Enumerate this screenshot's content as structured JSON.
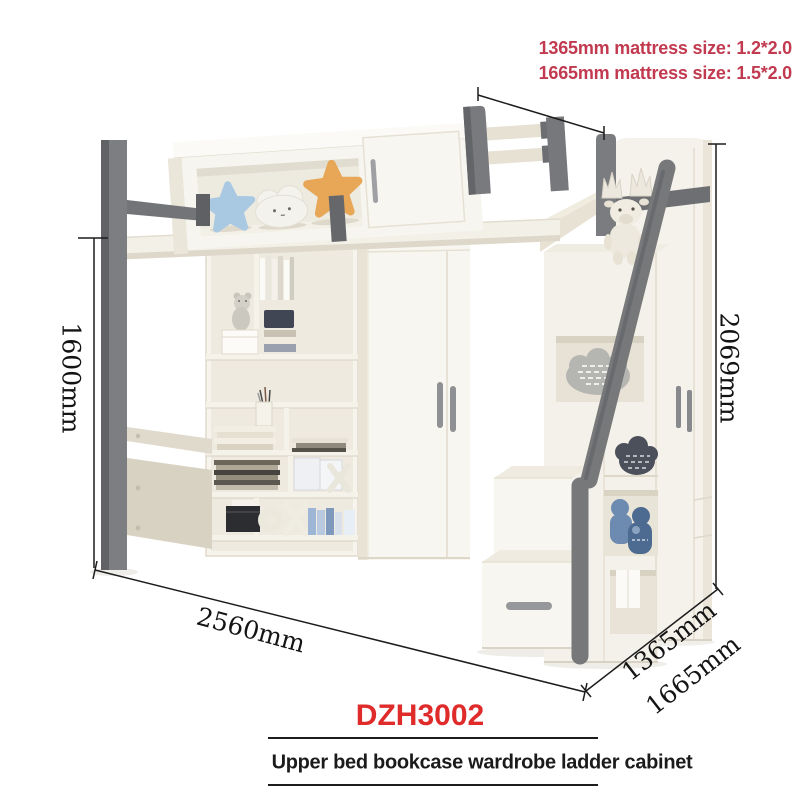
{
  "annotations": {
    "mattress_line1": "1365mm mattress size: 1.2*2.0",
    "mattress_line2": "1665mm mattress size: 1.5*2.0"
  },
  "dimensions": {
    "left_height": "1600mm",
    "right_height": "2069mm",
    "bottom_width": "2560mm",
    "depth_inner": "1365mm",
    "depth_outer": "1665mm"
  },
  "footer": {
    "model": "DZH3002",
    "caption": "Upper bed bookcase wardrobe ladder cabinet"
  },
  "colors": {
    "mattress_note_red": "#c13a4f",
    "model_red": "#e02b2b",
    "dimension_line": "#1c1c1c",
    "frame_gray": "#797a7d",
    "panel_white": "#f7f5ef",
    "panel_beige": "#e7e2d4",
    "star_blue": "#a9c9e3",
    "star_orange": "#e7a756",
    "cloud_white": "#f4f2ed",
    "denim_blue": "#5d7ea8"
  }
}
